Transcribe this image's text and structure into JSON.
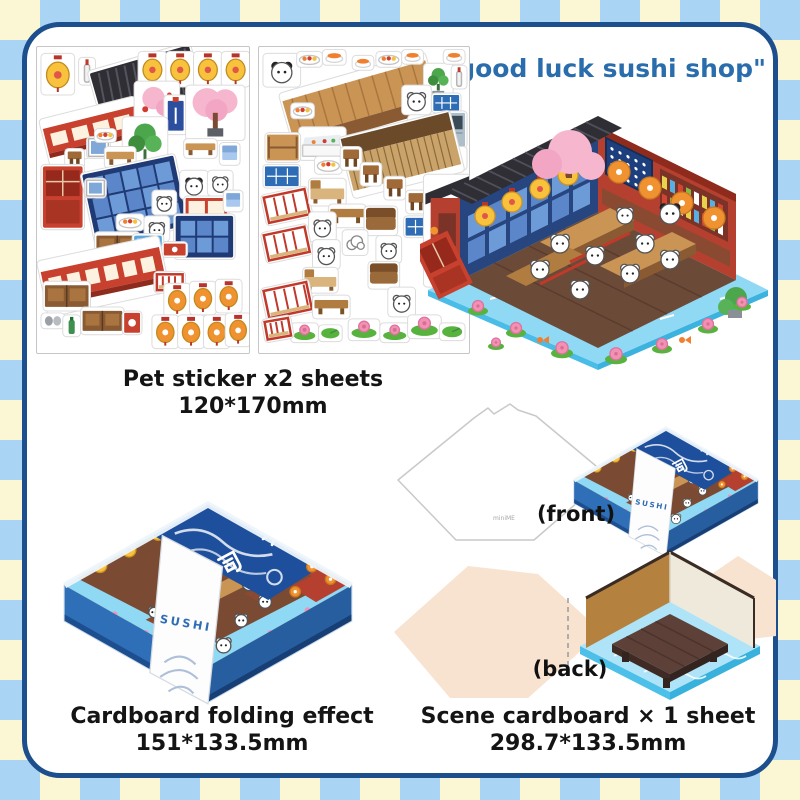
{
  "header": {
    "title": "\"good luck sushi shop\""
  },
  "sticker_section": {
    "caption": [
      "Pet sticker x2 sheets",
      "120*170mm"
    ]
  },
  "folding_section": {
    "caption": [
      "Cardboard folding effect",
      "151*133.5mm"
    ],
    "banner_kanji": "寿司",
    "band_text": "SUSHI"
  },
  "scene_section": {
    "caption": [
      "Scene cardboard × 1 sheet",
      "298.7*133.5mm"
    ],
    "front_label": "(front)",
    "back_label": "(back)",
    "brand_mark": "miniME"
  },
  "colors": {
    "check_blue": "#a9d4f3",
    "check_cream": "#fbf6d3",
    "panel_border": "#1d4f8e",
    "title_blue": "#2a6dad",
    "box_blue": "#2f6fb7",
    "banner_navy": "#1e4f9c",
    "water_blue": "#8fd9f4",
    "roof_black": "#2e2e34",
    "wall_red": "#b5402f",
    "lantern_yellow": "#f8c23d",
    "lantern_orange": "#f0922f",
    "sakura_pink": "#f5b6ce",
    "floor_brown": "#6b4a38",
    "blank_peach": "#f8e3d1"
  },
  "sheets": {
    "sheet1": {
      "items": [
        {
          "t": "lantern_y",
          "x": 6,
          "y": 8,
          "w": 30,
          "h": 38
        },
        {
          "t": "bottle",
          "x": 44,
          "y": 12,
          "w": 13,
          "h": 24
        },
        {
          "t": "roof",
          "x": 58,
          "y": 10,
          "w": 104,
          "h": 52,
          "r": -16
        },
        {
          "t": "lantern_y",
          "x": 104,
          "y": 6,
          "w": 25,
          "h": 32
        },
        {
          "t": "lantern_y",
          "x": 132,
          "y": 6,
          "w": 25,
          "h": 32
        },
        {
          "t": "lantern_y",
          "x": 160,
          "y": 6,
          "w": 25,
          "h": 32
        },
        {
          "t": "lantern_y",
          "x": 188,
          "y": 6,
          "w": 25,
          "h": 32
        },
        {
          "t": "shelf_red",
          "x": 8,
          "y": 62,
          "w": 96,
          "h": 46,
          "r": -14
        },
        {
          "t": "sakura_branch",
          "x": 100,
          "y": 36,
          "w": 42,
          "h": 40
        },
        {
          "t": "banner_small",
          "x": 130,
          "y": 50,
          "w": 20,
          "h": 36
        },
        {
          "t": "sakura_tree",
          "x": 152,
          "y": 40,
          "w": 56,
          "h": 52
        },
        {
          "t": "plant_green",
          "x": 88,
          "y": 72,
          "w": 42,
          "h": 56
        },
        {
          "t": "stool",
          "x": 30,
          "y": 104,
          "w": 16,
          "h": 16
        },
        {
          "t": "frame",
          "x": 52,
          "y": 92,
          "w": 20,
          "h": 18
        },
        {
          "t": "bench_w",
          "x": 70,
          "y": 102,
          "w": 28,
          "h": 18
        },
        {
          "t": "dish",
          "x": 60,
          "y": 84,
          "w": 18,
          "h": 10
        },
        {
          "t": "door_red",
          "x": 6,
          "y": 120,
          "w": 40,
          "h": 62
        },
        {
          "t": "window_blue",
          "x": 52,
          "y": 118,
          "w": 94,
          "h": 72,
          "r": -12
        },
        {
          "t": "frame",
          "x": 50,
          "y": 134,
          "w": 18,
          "h": 16
        },
        {
          "t": "bench_w",
          "x": 150,
          "y": 94,
          "w": 30,
          "h": 16
        },
        {
          "t": "chair_blue",
          "x": 186,
          "y": 98,
          "w": 17,
          "h": 19
        },
        {
          "t": "panda",
          "x": 146,
          "y": 126,
          "w": 25,
          "h": 25
        },
        {
          "t": "animal",
          "x": 174,
          "y": 126,
          "w": 22,
          "h": 22
        },
        {
          "t": "shelf_red2",
          "x": 150,
          "y": 152,
          "w": 42,
          "h": 20
        },
        {
          "t": "chair_blue",
          "x": 190,
          "y": 146,
          "w": 16,
          "h": 18
        },
        {
          "t": "animal",
          "x": 118,
          "y": 146,
          "w": 21,
          "h": 21
        },
        {
          "t": "dish",
          "x": 82,
          "y": 170,
          "w": 24,
          "h": 13
        },
        {
          "t": "animal",
          "x": 110,
          "y": 172,
          "w": 22,
          "h": 22
        },
        {
          "t": "window_dark",
          "x": 140,
          "y": 170,
          "w": 58,
          "h": 42
        },
        {
          "t": "cabinet",
          "x": 60,
          "y": 188,
          "w": 42,
          "h": 24
        },
        {
          "t": "vending",
          "x": 98,
          "y": 190,
          "w": 28,
          "h": 46
        },
        {
          "t": "sign_red",
          "x": 128,
          "y": 198,
          "w": 22,
          "h": 12
        },
        {
          "t": "shelf_red",
          "x": 6,
          "y": 204,
          "w": 122,
          "h": 54,
          "r": -12
        },
        {
          "t": "cabinet",
          "x": 8,
          "y": 238,
          "w": 44,
          "h": 26
        },
        {
          "t": "slippers",
          "x": 6,
          "y": 270,
          "w": 20,
          "h": 12
        },
        {
          "t": "bottle_g",
          "x": 28,
          "y": 272,
          "w": 14,
          "h": 18
        },
        {
          "t": "cabinet",
          "x": 46,
          "y": 264,
          "w": 40,
          "h": 24
        },
        {
          "t": "sign_red",
          "x": 88,
          "y": 268,
          "w": 16,
          "h": 20
        },
        {
          "t": "fence_small",
          "x": 120,
          "y": 228,
          "w": 28,
          "h": 18
        },
        {
          "t": "lantern_o",
          "x": 130,
          "y": 240,
          "w": 23,
          "h": 30
        },
        {
          "t": "lantern_o",
          "x": 156,
          "y": 238,
          "w": 23,
          "h": 30
        },
        {
          "t": "lantern_o",
          "x": 182,
          "y": 236,
          "w": 23,
          "h": 30
        },
        {
          "t": "lantern_o",
          "x": 118,
          "y": 272,
          "w": 23,
          "h": 30
        },
        {
          "t": "lantern_o",
          "x": 144,
          "y": 272,
          "w": 23,
          "h": 30
        },
        {
          "t": "lantern_o",
          "x": 170,
          "y": 272,
          "w": 23,
          "h": 30
        },
        {
          "t": "lantern_o",
          "x": 192,
          "y": 270,
          "w": 22,
          "h": 30
        }
      ]
    },
    "sheet2": {
      "items": [
        {
          "t": "panda",
          "x": 6,
          "y": 8,
          "w": 34,
          "h": 30
        },
        {
          "t": "dish",
          "x": 40,
          "y": 6,
          "w": 22,
          "h": 12
        },
        {
          "t": "food",
          "x": 66,
          "y": 4,
          "w": 20,
          "h": 12
        },
        {
          "t": "counter_wood",
          "x": 28,
          "y": 26,
          "w": 150,
          "h": 66,
          "r": -16
        },
        {
          "t": "dish",
          "x": 34,
          "y": 58,
          "w": 20,
          "h": 12
        },
        {
          "t": "food",
          "x": 96,
          "y": 10,
          "w": 18,
          "h": 11
        },
        {
          "t": "dish",
          "x": 120,
          "y": 6,
          "w": 22,
          "h": 12
        },
        {
          "t": "food",
          "x": 146,
          "y": 4,
          "w": 18,
          "h": 11
        },
        {
          "t": "plant_green",
          "x": 168,
          "y": 18,
          "w": 26,
          "h": 34
        },
        {
          "t": "food",
          "x": 188,
          "y": 4,
          "w": 18,
          "h": 11
        },
        {
          "t": "bottle",
          "x": 196,
          "y": 20,
          "w": 12,
          "h": 20
        },
        {
          "t": "animal",
          "x": 146,
          "y": 40,
          "w": 26,
          "h": 26
        },
        {
          "t": "tray_blue",
          "x": 176,
          "y": 48,
          "w": 26,
          "h": 16
        },
        {
          "t": "fridge",
          "x": 184,
          "y": 66,
          "w": 24,
          "h": 34
        },
        {
          "t": "animal",
          "x": 152,
          "y": 70,
          "w": 22,
          "h": 26
        },
        {
          "t": "bottle_g",
          "x": 190,
          "y": 102,
          "w": 18,
          "h": 20
        },
        {
          "t": "case_white",
          "x": 42,
          "y": 82,
          "w": 44,
          "h": 30
        },
        {
          "t": "shelf_low",
          "x": 8,
          "y": 88,
          "w": 32,
          "h": 26
        },
        {
          "t": "dish",
          "x": 58,
          "y": 112,
          "w": 24,
          "h": 14
        },
        {
          "t": "counter_dark",
          "x": 88,
          "y": 78,
          "w": 112,
          "h": 60,
          "r": -14
        },
        {
          "t": "tray_blue",
          "x": 6,
          "y": 120,
          "w": 34,
          "h": 20
        },
        {
          "t": "stool",
          "x": 84,
          "y": 102,
          "w": 18,
          "h": 20
        },
        {
          "t": "stool",
          "x": 104,
          "y": 118,
          "w": 18,
          "h": 20
        },
        {
          "t": "stool",
          "x": 128,
          "y": 132,
          "w": 18,
          "h": 20
        },
        {
          "t": "stool",
          "x": 150,
          "y": 146,
          "w": 18,
          "h": 20
        },
        {
          "t": "fence_red",
          "x": 6,
          "y": 146,
          "w": 44,
          "h": 28,
          "r": -12
        },
        {
          "t": "bench_tan",
          "x": 52,
          "y": 134,
          "w": 34,
          "h": 24
        },
        {
          "t": "table_low",
          "x": 72,
          "y": 160,
          "w": 34,
          "h": 20
        },
        {
          "t": "animal",
          "x": 52,
          "y": 168,
          "w": 24,
          "h": 26
        },
        {
          "t": "sofa",
          "x": 108,
          "y": 162,
          "w": 30,
          "h": 26
        },
        {
          "t": "fence_red",
          "x": 6,
          "y": 184,
          "w": 44,
          "h": 28,
          "r": -12
        },
        {
          "t": "animal",
          "x": 56,
          "y": 196,
          "w": 24,
          "h": 26
        },
        {
          "t": "cloud",
          "x": 86,
          "y": 186,
          "w": 22,
          "h": 22
        },
        {
          "t": "tray_blue",
          "x": 148,
          "y": 172,
          "w": 30,
          "h": 18
        },
        {
          "t": "animal",
          "x": 120,
          "y": 192,
          "w": 22,
          "h": 24
        },
        {
          "t": "shop_corner",
          "x": 168,
          "y": 130,
          "w": 44,
          "h": 110
        },
        {
          "t": "bench_tan",
          "x": 46,
          "y": 224,
          "w": 32,
          "h": 22
        },
        {
          "t": "sofa",
          "x": 112,
          "y": 218,
          "w": 28,
          "h": 24
        },
        {
          "t": "fence_red",
          "x": 6,
          "y": 240,
          "w": 46,
          "h": 30,
          "r": -12
        },
        {
          "t": "table_low",
          "x": 56,
          "y": 252,
          "w": 34,
          "h": 20
        },
        {
          "t": "animal",
          "x": 132,
          "y": 244,
          "w": 24,
          "h": 26
        },
        {
          "t": "lotus",
          "x": 92,
          "y": 276,
          "w": 28,
          "h": 18
        },
        {
          "t": "lotus",
          "x": 124,
          "y": 280,
          "w": 26,
          "h": 16
        },
        {
          "t": "leaf",
          "x": 62,
          "y": 282,
          "w": 20,
          "h": 13
        },
        {
          "t": "lotus",
          "x": 152,
          "y": 272,
          "w": 30,
          "h": 20
        },
        {
          "t": "leaf",
          "x": 184,
          "y": 280,
          "w": 22,
          "h": 14
        },
        {
          "t": "lotus",
          "x": 34,
          "y": 280,
          "w": 24,
          "h": 16
        },
        {
          "t": "fence_red",
          "x": 6,
          "y": 274,
          "w": 26,
          "h": 20,
          "r": -10
        }
      ]
    }
  }
}
